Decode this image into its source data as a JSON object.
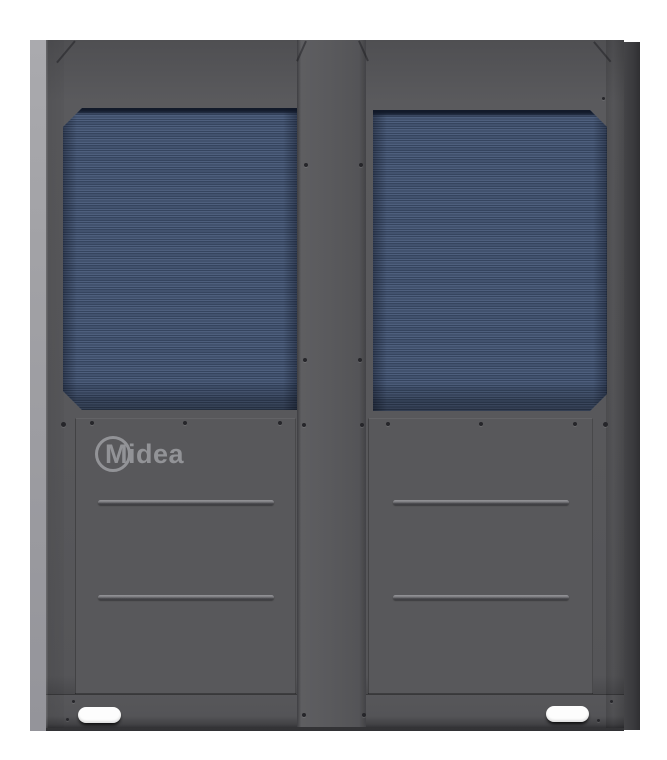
{
  "photo": {
    "subject": "Midea outdoor HVAC unit, front view with two blue heat-exchanger coil panels",
    "brand_logo": "Midea"
  },
  "colors": {
    "background": "#ffffff",
    "cabinet_face": "#58585b",
    "side_panel_light": "#a2a2a6",
    "side_panel_dark": "#3a3a3d",
    "coil_blue_light": "#4e5f7d",
    "coil_blue_dark": "#36455f",
    "groove_highlight": "#96969a",
    "groove_shadow": "#3a3a3e",
    "logo_gray": "#9b9ca0",
    "slot_white": "#fdfdfd",
    "screw_dark": "#26262a"
  }
}
